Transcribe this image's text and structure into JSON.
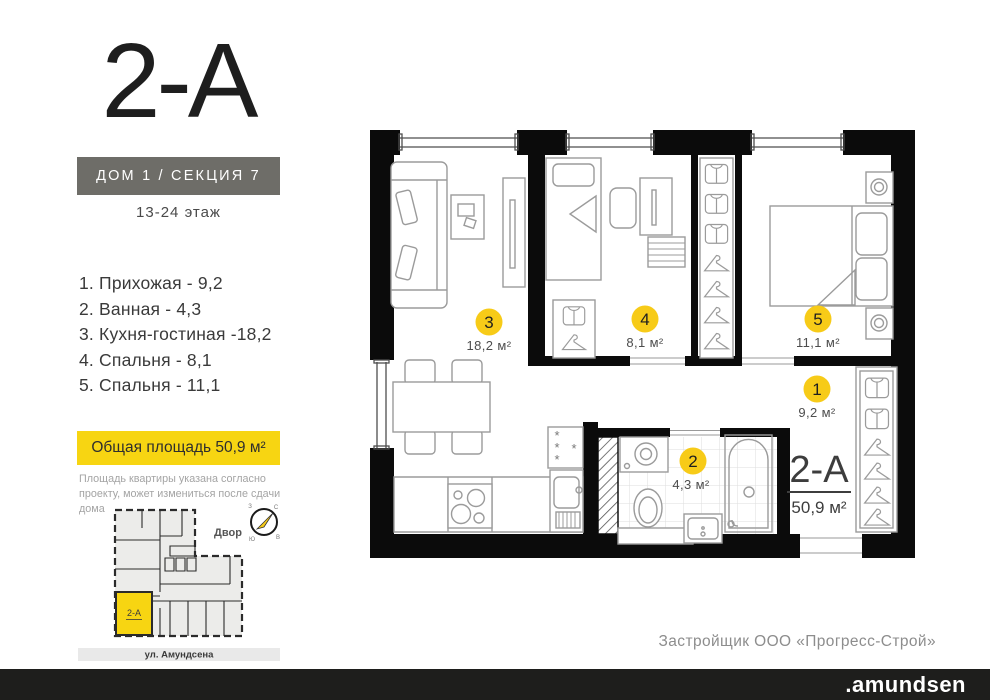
{
  "header": {
    "plan_code": "2-А",
    "building": "ДОМ 1 / СЕКЦИЯ 7",
    "floors": "13-24 этаж"
  },
  "rooms": [
    {
      "num": "1",
      "name": "Прихожая",
      "area": "9,2",
      "area_m2": "9,2 м²",
      "list_label": "1.  Прихожая - 9,2"
    },
    {
      "num": "2",
      "name": "Ванная",
      "area": "4,3",
      "area_m2": "4,3 м²",
      "list_label": "2.  Ванная - 4,3"
    },
    {
      "num": "3",
      "name": "Кухня-гостиная",
      "area": "18,2",
      "area_m2": "18,2 м²",
      "list_label": "3.  Кухня-гостиная -18,2"
    },
    {
      "num": "4",
      "name": "Спальня",
      "area": "8,1",
      "area_m2": "8,1 м²",
      "list_label": "4.  Спальня - 8,1"
    },
    {
      "num": "5",
      "name": "Спальня",
      "area": "11,1",
      "area_m2": "11,1 м²",
      "list_label": "5.  Спальня - 11,1"
    }
  ],
  "total_area": {
    "label": "Общая площадь 50,9 м²",
    "value": "50,9 м²"
  },
  "disclaimer": "Площадь квартиры указана согласно проекту, может измениться после сдачи дома",
  "plan": {
    "apartment_code": "2-А",
    "apartment_area": "50,9 м²",
    "fridge_marks": {
      "a": "*",
      "b": "*",
      "c": "*",
      "d": "*"
    }
  },
  "site_plan": {
    "yard_label": "Двор",
    "street_label": "ул. Амундсена",
    "unit_label": "2-А",
    "compass": {
      "n": "С",
      "e": "В",
      "s": "Ю",
      "w": "З"
    }
  },
  "footer": {
    "developer": "Застройщик ООО «Прогресс-Строй»",
    "brand": ".amundsen"
  },
  "colors": {
    "accent_yellow": "#f7d512",
    "badge_yellow": "#f7cb18",
    "wall_black": "#0b0b0b",
    "section_box_gray": "#6e6d68",
    "footer_bar": "#1e1e1c"
  }
}
